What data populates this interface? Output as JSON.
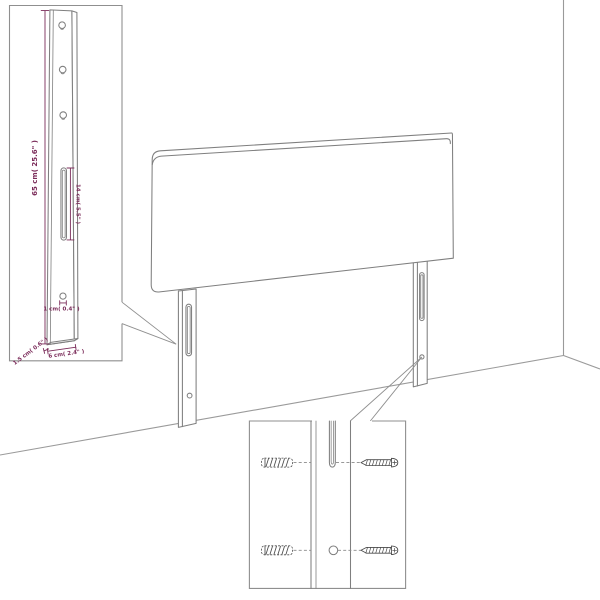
{
  "diagram": {
    "type": "product-dimension-diagram",
    "subject": "upholstered headboard with two mounting legs, leg detail inset and hardware detail inset",
    "colors": {
      "line": "#7f7f7f",
      "room_line": "#9a9a9a",
      "dimension": "#7b2c5a",
      "hardware": "#4a4a4a",
      "background": "#ffffff"
    },
    "leg_detail": {
      "height": "65 cm( 25.6\" )",
      "slot_length": "14 cm( 5.5\" )",
      "hole_diameter": "1 cm( 0.4\" )",
      "thickness": "1.5 cm( 0.6\" )",
      "width": "6 cm( 2.4\" )"
    }
  }
}
